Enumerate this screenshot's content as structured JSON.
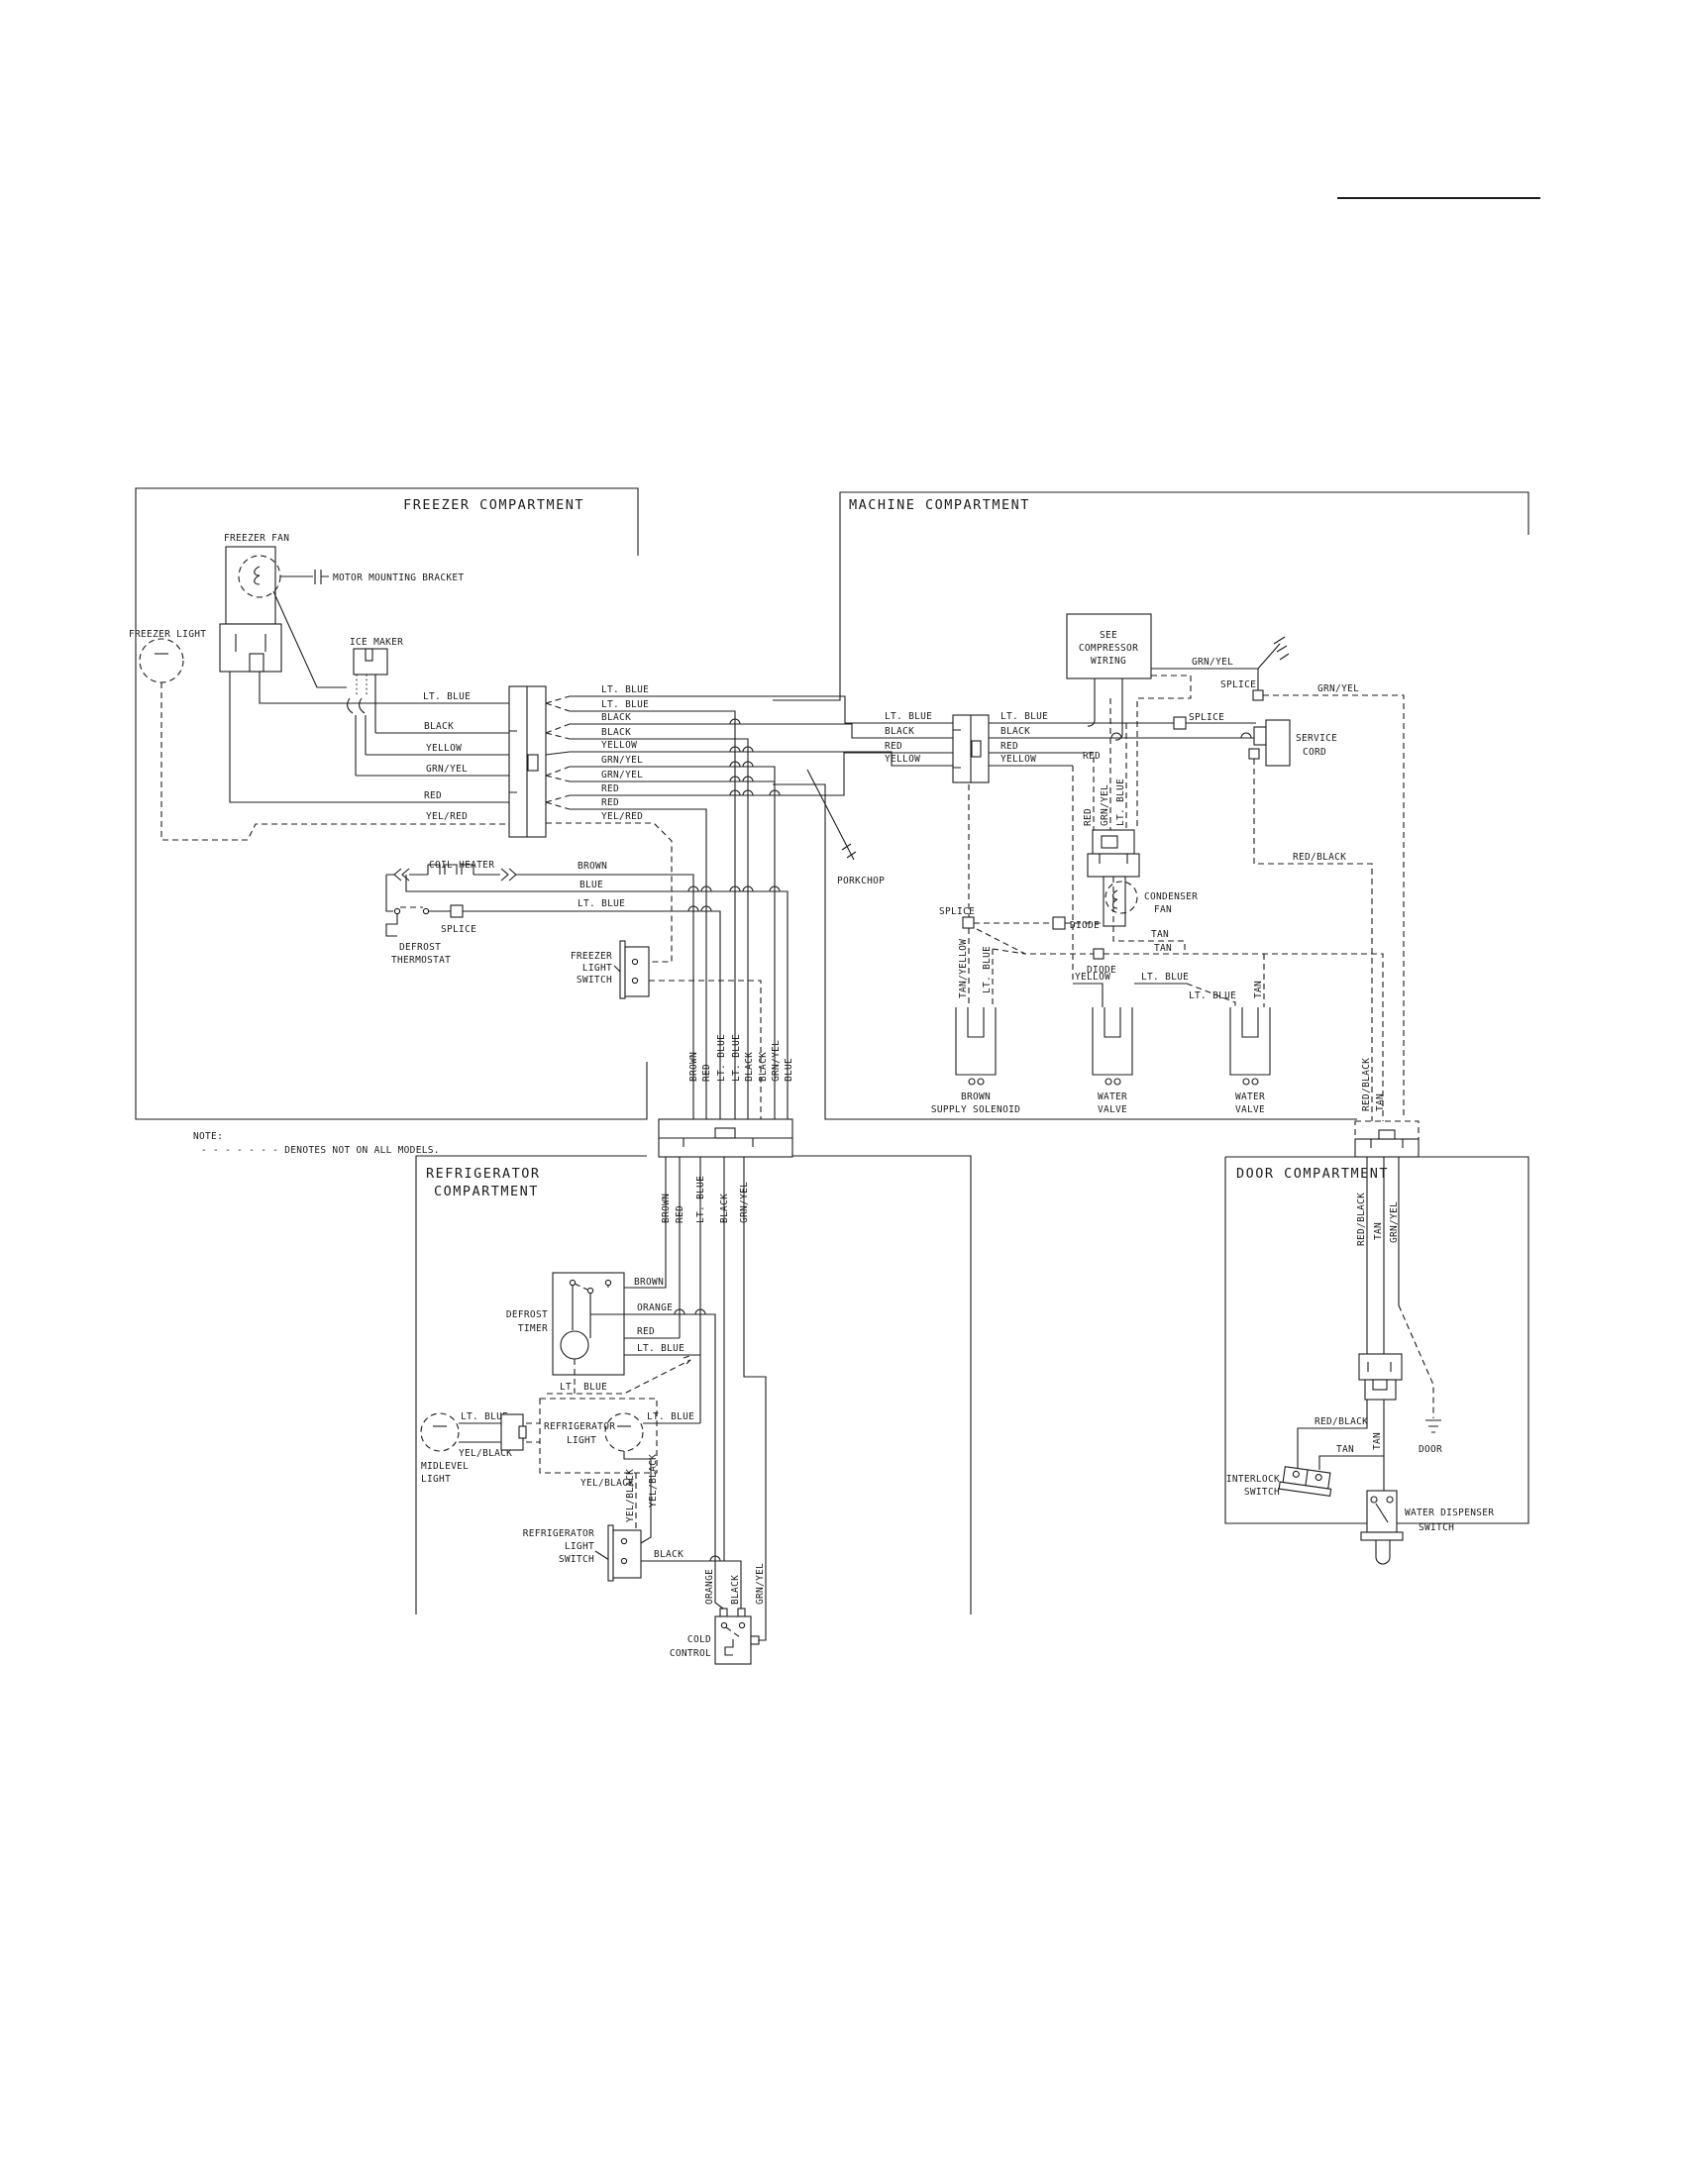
{
  "note": {
    "heading": "NOTE:",
    "text": "- - - - - - -  DENOTES NOT ON ALL MODELS."
  },
  "freezer": {
    "title": "FREEZER COMPARTMENT",
    "fan": "FREEZER FAN",
    "bracket": "MOTOR MOUNTING BRACKET",
    "light": "FREEZER LIGHT",
    "ice_maker": "ICE MAKER",
    "wires_left": [
      "LT. BLUE",
      "BLACK",
      "YELLOW",
      "GRN/YEL",
      "RED",
      "YEL/RED"
    ],
    "wires_right": [
      "LT. BLUE",
      "LT. BLUE",
      "BLACK",
      "BLACK",
      "YELLOW",
      "GRN/YEL",
      "GRN/YEL",
      "RED",
      "RED",
      "YEL/RED"
    ],
    "coil_heater": "COIL HEATER",
    "heater_brown": "BROWN",
    "heater_blue": "BLUE",
    "heater_lt_blue": "LT. BLUE",
    "splice": "SPLICE",
    "thermostat_l1": "DEFROST",
    "thermostat_l2": "THERMOSTAT",
    "switch_l1": "FREEZER",
    "switch_l2": "LIGHT",
    "switch_l3": "SWITCH",
    "bundle": [
      "BROWN",
      "RED",
      "LT. BLUE",
      "LT. BLUE",
      "BLACK",
      "BLACK",
      "GRN/YEL",
      "BLUE"
    ]
  },
  "machine": {
    "title": "MACHINE COMPARTMENT",
    "conn_left": [
      "LT. BLUE",
      "BLACK",
      "RED",
      "YELLOW"
    ],
    "conn_right": [
      "LT. BLUE",
      "BLACK",
      "RED",
      "YELLOW"
    ],
    "compressor_l1": "SEE",
    "compressor_l2": "COMPRESSOR",
    "compressor_l3": "WIRING",
    "grn_yel": "GRN/YEL",
    "grn_yel_dash": "GRN/YEL",
    "splice_top": "SPLICE",
    "splice_mid": "SPLICE",
    "splice_low": "SPLICE",
    "service_l1": "SERVICE",
    "service_l2": "CORD",
    "red_tap": "RED",
    "relay": [
      "RED",
      "GRN/YEL",
      "LT. BLUE"
    ],
    "condenser_l1": "CONDENSER",
    "condenser_l2": "FAN",
    "porkchop": "PORKCHOP",
    "diode1": "DIODE",
    "diode2": "DIODE",
    "tan1": "TAN",
    "tan2": "TAN",
    "tan_v": "TAN",
    "tan_yellow": "TAN/YELLOW",
    "lt_blue_v": "LT. BLUE",
    "yellow": "YELLOW",
    "lt_blue_h": "LT. BLUE",
    "lt_blue_d": "LT. BLUE",
    "red_black": "RED/BLACK",
    "red_black_v": "RED/BLACK",
    "tan_feed": "TAN",
    "solenoid_l1": "BROWN",
    "solenoid_l2": "SUPPLY SOLENOID",
    "valve1_l1": "WATER",
    "valve1_l2": "VALVE",
    "valve2_l1": "WATER",
    "valve2_l2": "VALVE"
  },
  "fridge": {
    "title_l1": "REFRIGERATOR",
    "title_l2": "COMPARTMENT",
    "drops": [
      "BROWN",
      "RED",
      "LT. BLUE",
      "BLACK",
      "GRN/YEL"
    ],
    "timer_l1": "DEFROST",
    "timer_l2": "TIMER",
    "w_brown": "BROWN",
    "w_orange": "ORANGE",
    "w_red": "RED",
    "w_lt_blue": "LT. BLUE",
    "w_lt_blue_d": "LT. BLUE",
    "midlevel_l1": "MIDLEVEL",
    "midlevel_l2": "LIGHT",
    "mid_lt_blue": "LT. BLUE",
    "mid_yel_black": "YEL/BLACK",
    "light_l1": "REFRIGERATOR",
    "light_l2": "LIGHT",
    "light_lt_blue": "LT. BLUE",
    "yel_black_h": "YEL/BLACK",
    "yel_black_v1": "YEL/BLACK",
    "yel_black_v2": "YEL/BLACK",
    "switch_l1": "REFRIGERATOR",
    "switch_l2": "LIGHT",
    "switch_l3": "SWITCH",
    "black": "BLACK",
    "cc": [
      "ORANGE",
      "BLACK",
      "GRN/YEL"
    ],
    "cold_l1": "COLD",
    "cold_l2": "CONTROL"
  },
  "door": {
    "title": "DOOR COMPARTMENT",
    "drops": [
      "RED/BLACK",
      "TAN",
      "GRN/YEL"
    ],
    "red_black": "RED/BLACK",
    "tan_h": "TAN",
    "tan_v": "TAN",
    "ground": "DOOR",
    "interlock_l1": "INTERLOCK",
    "interlock_l2": "SWITCH",
    "dispenser_l1": "WATER DISPENSER",
    "dispenser_l2": "SWITCH"
  }
}
